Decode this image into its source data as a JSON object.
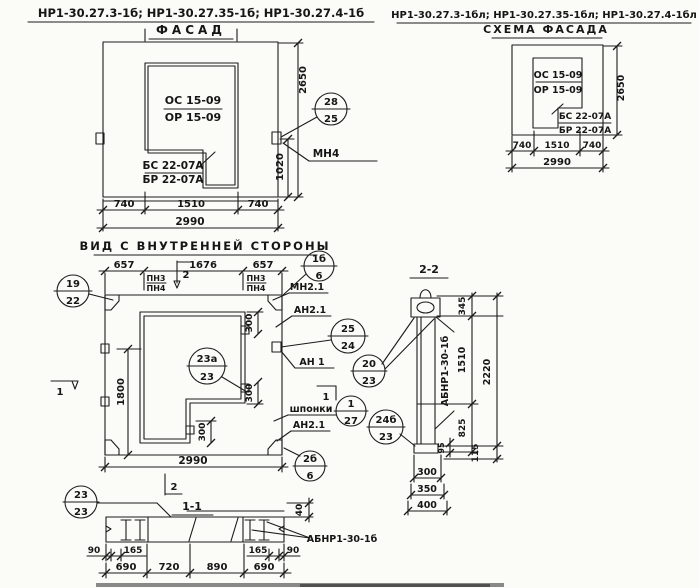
{
  "header": {
    "title_left": "НР1-30.27.3-1б; НР1-30.27.35-1б; НР1-30.27.4-1б",
    "title_right": "НР1-30.27.3-1бл; НР1-30.27.35-1бл; НР1-30.27.4-1бл"
  },
  "facade": {
    "title": "ФАСАД",
    "window_mark": [
      "ОС 15-09",
      "ОР 15-09"
    ],
    "corner_mark": [
      "БС 22-07А",
      "БР 22-07А"
    ],
    "dims": [
      "740",
      "1510",
      "740",
      "2990",
      "2650",
      "1020"
    ],
    "anchor": "МН4",
    "callout": [
      "28",
      "25"
    ]
  },
  "scheme": {
    "title": "СХЕМА ФАСАДА",
    "window_mark": [
      "ОС 15-09",
      "ОР 15-09"
    ],
    "corner_mark": [
      "БС 22-07А",
      "БР 22-07А"
    ],
    "dims": [
      "740",
      "1510",
      "740",
      "2990",
      "2650"
    ]
  },
  "inner": {
    "title": "ВИД С ВНУТРЕННЕЙ СТОРОНЫ",
    "dims_top": [
      "657",
      "1676",
      "657"
    ],
    "dim_1800": "1800",
    "dim_300": "300",
    "dim_total": "2990",
    "pn": [
      "ПН3",
      "ПН4"
    ],
    "mn21": "МН2.1",
    "an21": "АН2.1",
    "an1": "АН 1",
    "shponki": "шпонки",
    "mark1": "1",
    "mark2": "2",
    "callouts": {
      "c19": [
        "19",
        "22"
      ],
      "c1b": [
        "1б",
        "6"
      ],
      "c25": [
        "25",
        "24"
      ],
      "c23a": [
        "23а",
        "23"
      ],
      "c127": [
        "1",
        "27"
      ],
      "c2b": [
        "2б",
        "6"
      ],
      "c20": [
        "20",
        "23"
      ],
      "c24b": [
        "24б",
        "23"
      ]
    }
  },
  "sec22": {
    "title": "2-2",
    "label": "АБНР1-30-1б",
    "d345": "345",
    "d1510": "1510",
    "d825": "825",
    "d2220": "2220",
    "d95": "95",
    "d115": "115",
    "d300": "300",
    "d350": "350",
    "d400": "400"
  },
  "sec11": {
    "title": "1-1",
    "label": "АБНР1-30-1б",
    "callout": [
      "23",
      "23"
    ],
    "d40": "40",
    "dims_edge": [
      "90",
      "165",
      "165",
      "90"
    ],
    "dims_bottom": [
      "690",
      "720",
      "890",
      "690"
    ]
  }
}
